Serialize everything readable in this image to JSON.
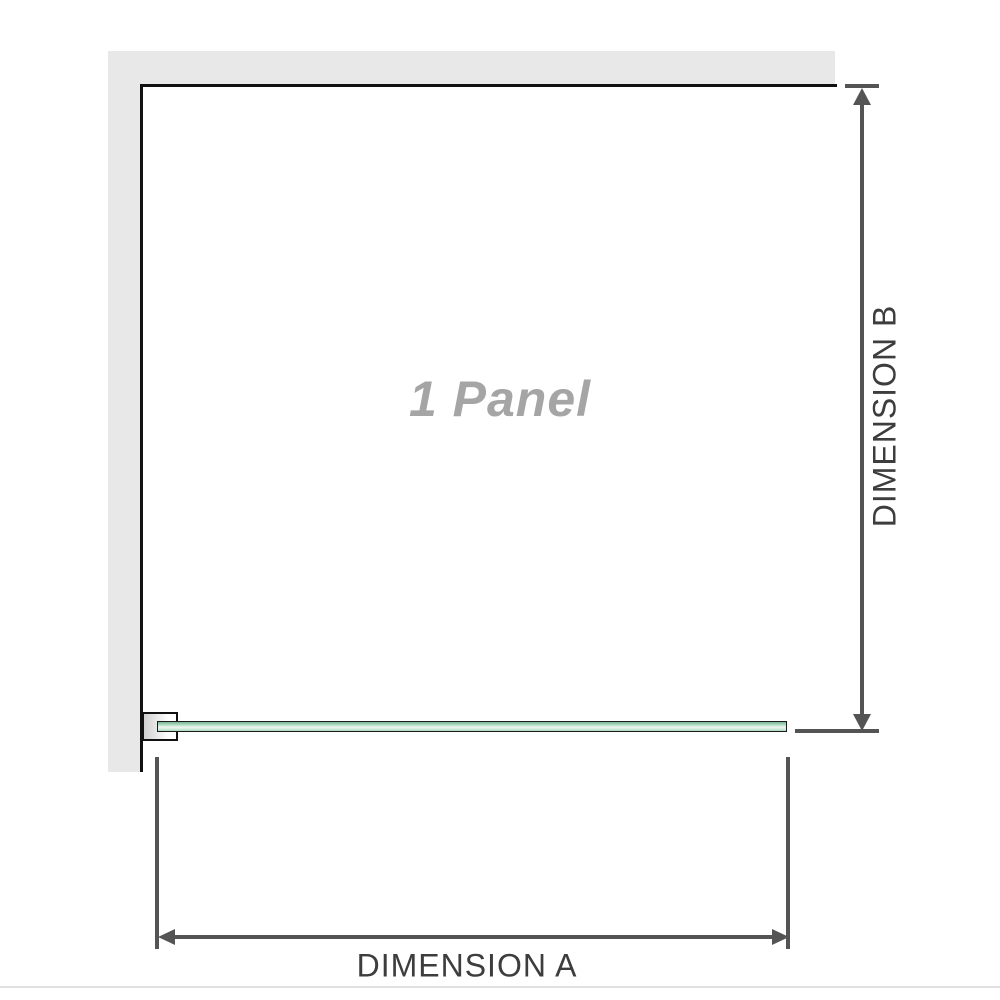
{
  "diagram": {
    "panel": {
      "label": "1 Panel"
    },
    "dimensions": {
      "a": {
        "label": "DIMENSION A"
      },
      "b": {
        "label": "DIMENSION B"
      }
    },
    "colors": {
      "wall": "#e8e8e8",
      "edge": "#111111",
      "glass_dark": "#79b593",
      "glass_mid": "#a9d8bd",
      "glass_light": "#e9f6ee",
      "dim_line": "#545454",
      "dim_text": "#3d3d3d",
      "panel_text": "#a5a5a5",
      "bracket_shade": "#cfcfcf",
      "divider": "#e0e0e0"
    }
  }
}
